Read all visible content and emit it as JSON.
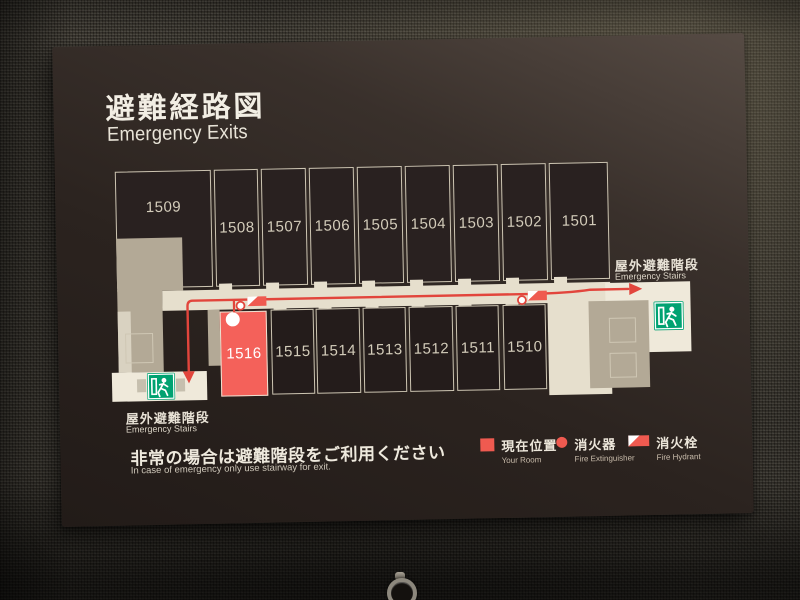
{
  "sign": {
    "title_jp": "避難経路図",
    "title_en": "Emergency Exits",
    "stairs_label_jp": "屋外避難階段",
    "stairs_label_en": "Emergency Stairs",
    "notice_jp": "非常の場合は避難階段をご利用ください",
    "notice_en": "In case of emergency only use stairway for exit."
  },
  "plan": {
    "rooms_top": [
      {
        "number": "1509"
      },
      {
        "number": "1508"
      },
      {
        "number": "1507"
      },
      {
        "number": "1506"
      },
      {
        "number": "1505"
      },
      {
        "number": "1504"
      },
      {
        "number": "1503"
      },
      {
        "number": "1502"
      },
      {
        "number": "1501"
      }
    ],
    "rooms_bottom": [
      {
        "number": "1516",
        "is_current": true
      },
      {
        "number": "1515"
      },
      {
        "number": "1514"
      },
      {
        "number": "1513"
      },
      {
        "number": "1512"
      },
      {
        "number": "1511"
      },
      {
        "number": "1510"
      }
    ],
    "current_room": "1516"
  },
  "legend": {
    "items": [
      {
        "symbol": "square",
        "jp": "現在位置",
        "en": "Your Room"
      },
      {
        "symbol": "circle",
        "jp": "消火器",
        "en": "Fire Extinguisher"
      },
      {
        "symbol": "flag",
        "jp": "消火栓",
        "en": "Fire Hydrant"
      }
    ]
  },
  "colors": {
    "marker_red": "#ef5a50",
    "room_highlight": "#f4615a",
    "route_red": "#e2453c",
    "exit_green": "#00a271",
    "corridor_cream": "#e6dfcd",
    "structure_taupe": "#b3a996",
    "outline_beige": "#cdc5b2"
  }
}
